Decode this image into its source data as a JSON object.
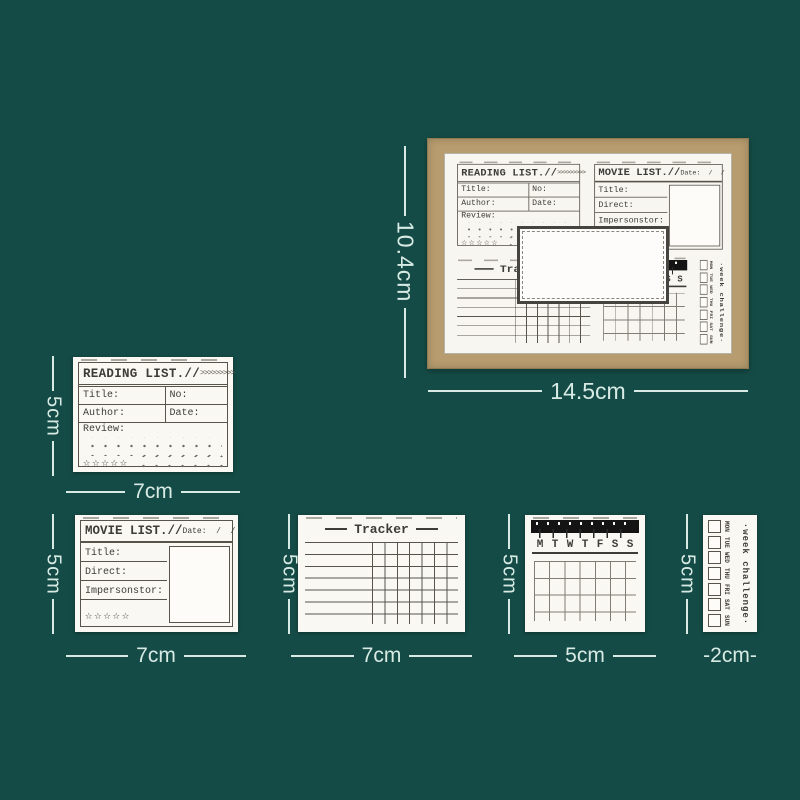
{
  "colors": {
    "background": "#154b46",
    "board_frame": "#b69c6e",
    "paper": "#f8f6f0",
    "stamp_ink": "#3e3c36",
    "measurement": "#d7eae4",
    "calendar_bar": "#141414"
  },
  "board": {
    "height_label": "10.4cm",
    "width_label": "14.5cm"
  },
  "reading_list": {
    "title": "READING LIST.//",
    "arrows": ">>>>>>>>>",
    "title_field": "Title:",
    "no_field": "No:",
    "author_field": "Author:",
    "date_field": "Date:",
    "review_field": "Review:",
    "stars": "☆☆☆☆☆",
    "height_label": "5cm",
    "width_label": "7cm"
  },
  "movie_list": {
    "title": "MOVIE LIST.//",
    "date_label": "Date:  /  /",
    "title_field": "Title:",
    "direct_field": "Direct:",
    "impersonator_field": "Impersonstor:",
    "stars": "☆☆☆☆☆",
    "height_label": "5cm",
    "width_label": "7cm"
  },
  "tracker": {
    "title": "Tracker",
    "height_label": "5cm",
    "width_label": "7cm"
  },
  "calendar": {
    "days": [
      "M",
      "T",
      "W",
      "T",
      "F",
      "S",
      "S"
    ],
    "height_label": "5cm",
    "width_label": "5cm"
  },
  "week_challenge": {
    "title": "·week challenge·",
    "days": [
      "MON",
      "TUE",
      "WED",
      "THU",
      "FRI",
      "SAT",
      "SUN"
    ],
    "height_label": "5cm",
    "width_label": "-2cm-"
  }
}
